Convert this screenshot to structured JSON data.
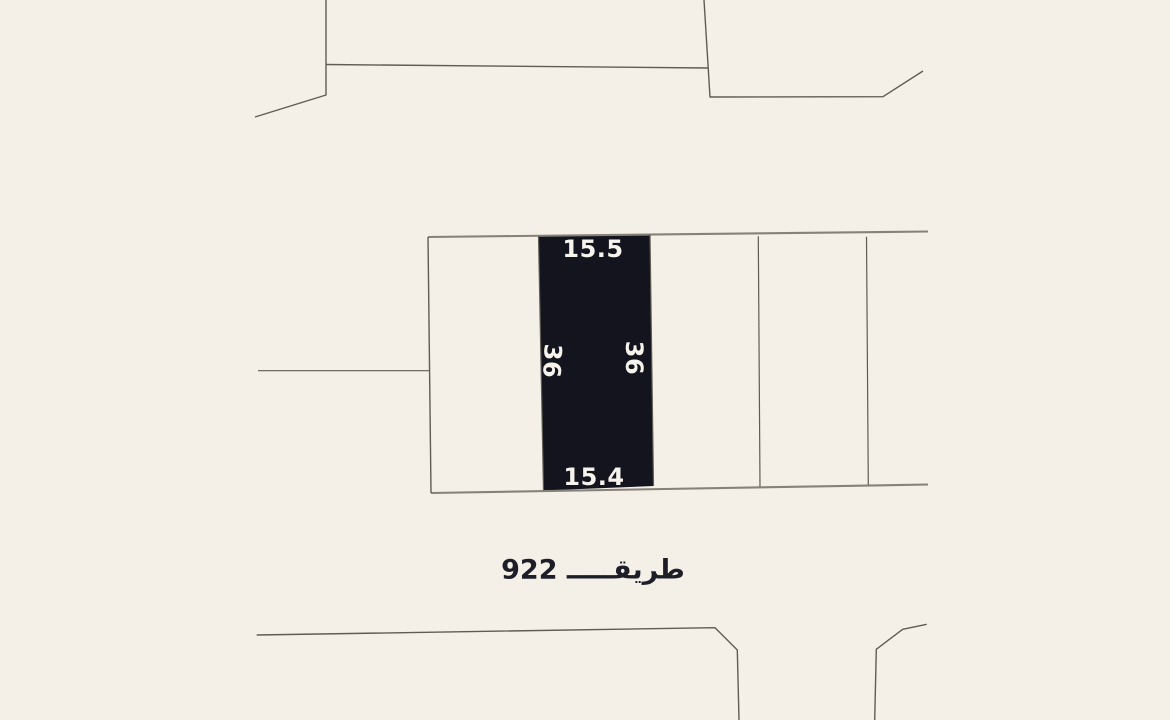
{
  "map": {
    "background_color": "#f4efe7",
    "boundary_line_color": "#605c54",
    "road_edge_color": "#878279",
    "selected_parcel": {
      "fill": "#14141f",
      "label_color": "#f6f3ec",
      "dimensions": {
        "top": "15.5",
        "bottom": "15.4",
        "left": "36",
        "right": "36"
      }
    },
    "road_label": {
      "text": "طريقـــــ 922",
      "road_number": "922",
      "color": "#1e1e29"
    }
  }
}
